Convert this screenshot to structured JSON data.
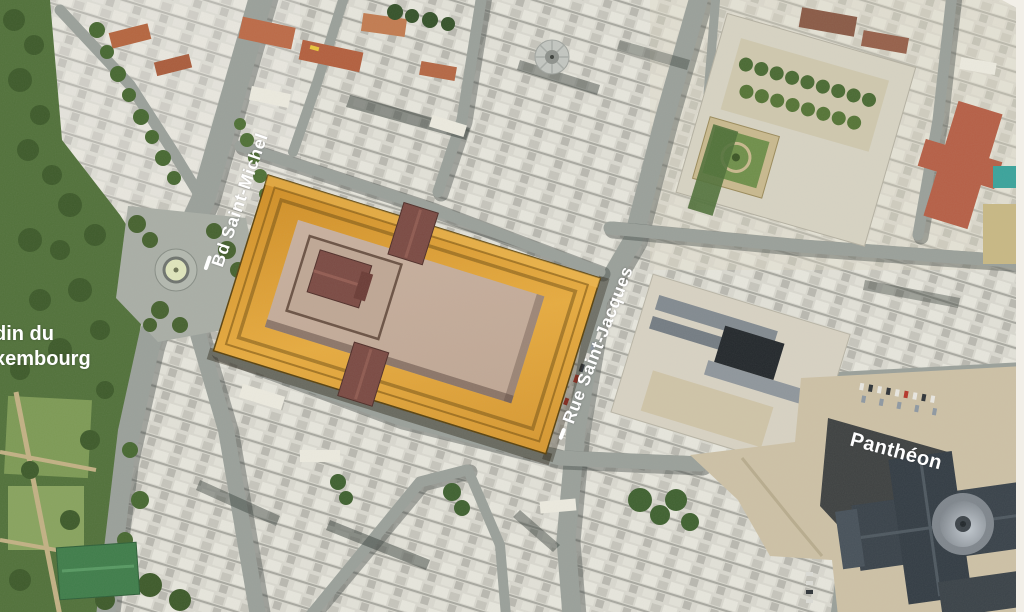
{
  "labels": {
    "bd_saint_michel": {
      "text": "Bd Saint-Michel"
    },
    "rue_saint_jacques": {
      "text": "Rue Saint-Jacques"
    },
    "jardin_luxembourg": {
      "line1": "din du",
      "line2": "xembourg"
    },
    "pantheon": {
      "text": "Panthéon"
    }
  },
  "colors": {
    "label-white": "#ffffff",
    "street-gray": "#9aa09a",
    "park-green": "#51713a",
    "plaza-tan": "#cdc1a6",
    "pantheon-slate": "#39424a",
    "overlay-orange": "#d99a31",
    "overlay-orange-bright": "#e9ad41",
    "overlay-orange-dark": "#7d5413",
    "overlay-platform": "#c4ab99",
    "overlay-roof-maroon": "#7b4a43"
  }
}
